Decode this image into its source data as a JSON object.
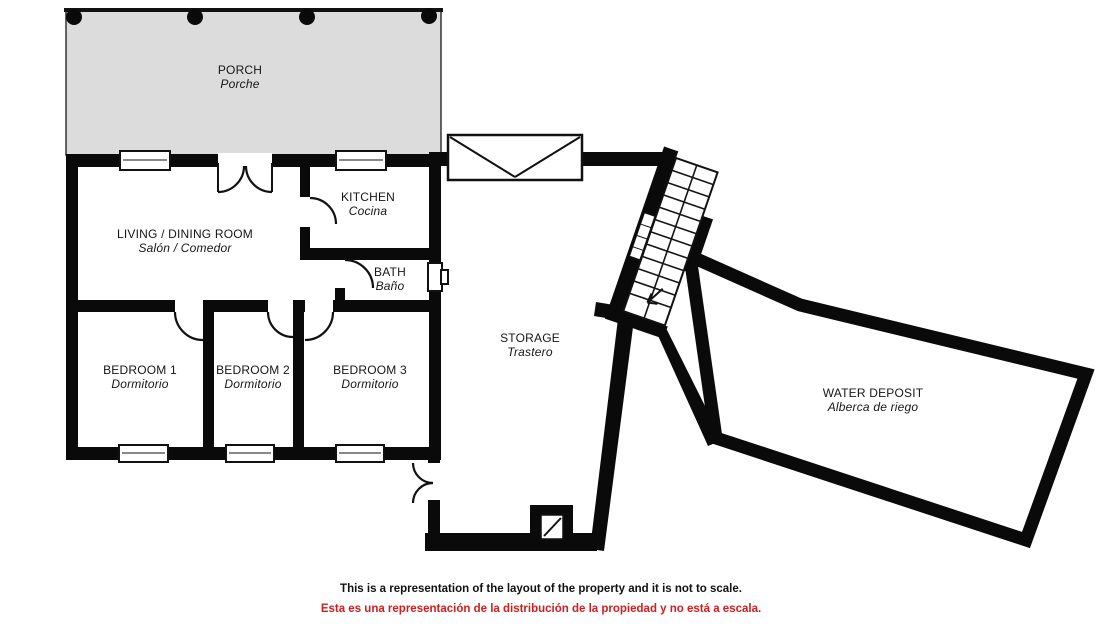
{
  "plan": {
    "rooms": {
      "porch": {
        "en": "PORCH",
        "es": "Porche"
      },
      "living": {
        "en": "LIVING / DINING ROOM",
        "es": "Salón / Comedor"
      },
      "kitchen": {
        "en": "KITCHEN",
        "es": "Cocina"
      },
      "bath": {
        "en": "BATH",
        "es": "Baño"
      },
      "bedroom1": {
        "en": "BEDROOM 1",
        "es": "Dormitorio"
      },
      "bedroom2": {
        "en": "BEDROOM 2",
        "es": "Dormitorio"
      },
      "bedroom3": {
        "en": "BEDROOM 3",
        "es": "Dormitorio"
      },
      "storage": {
        "en": "STORAGE",
        "es": "Trastero"
      },
      "water_deposit": {
        "en": "WATER DEPOSIT",
        "es": "Alberca de riego"
      }
    },
    "disclaimer": {
      "en": "This is a representation of the layout of the property and it is not to scale.",
      "es": "Esta es una representación de la distribución de la propiedad y no está a escala."
    },
    "colors": {
      "wall": "#0a0a0a",
      "porch_fill": "#dcdcdc",
      "disclaimer_red": "#cc2020",
      "background": "#ffffff"
    }
  }
}
